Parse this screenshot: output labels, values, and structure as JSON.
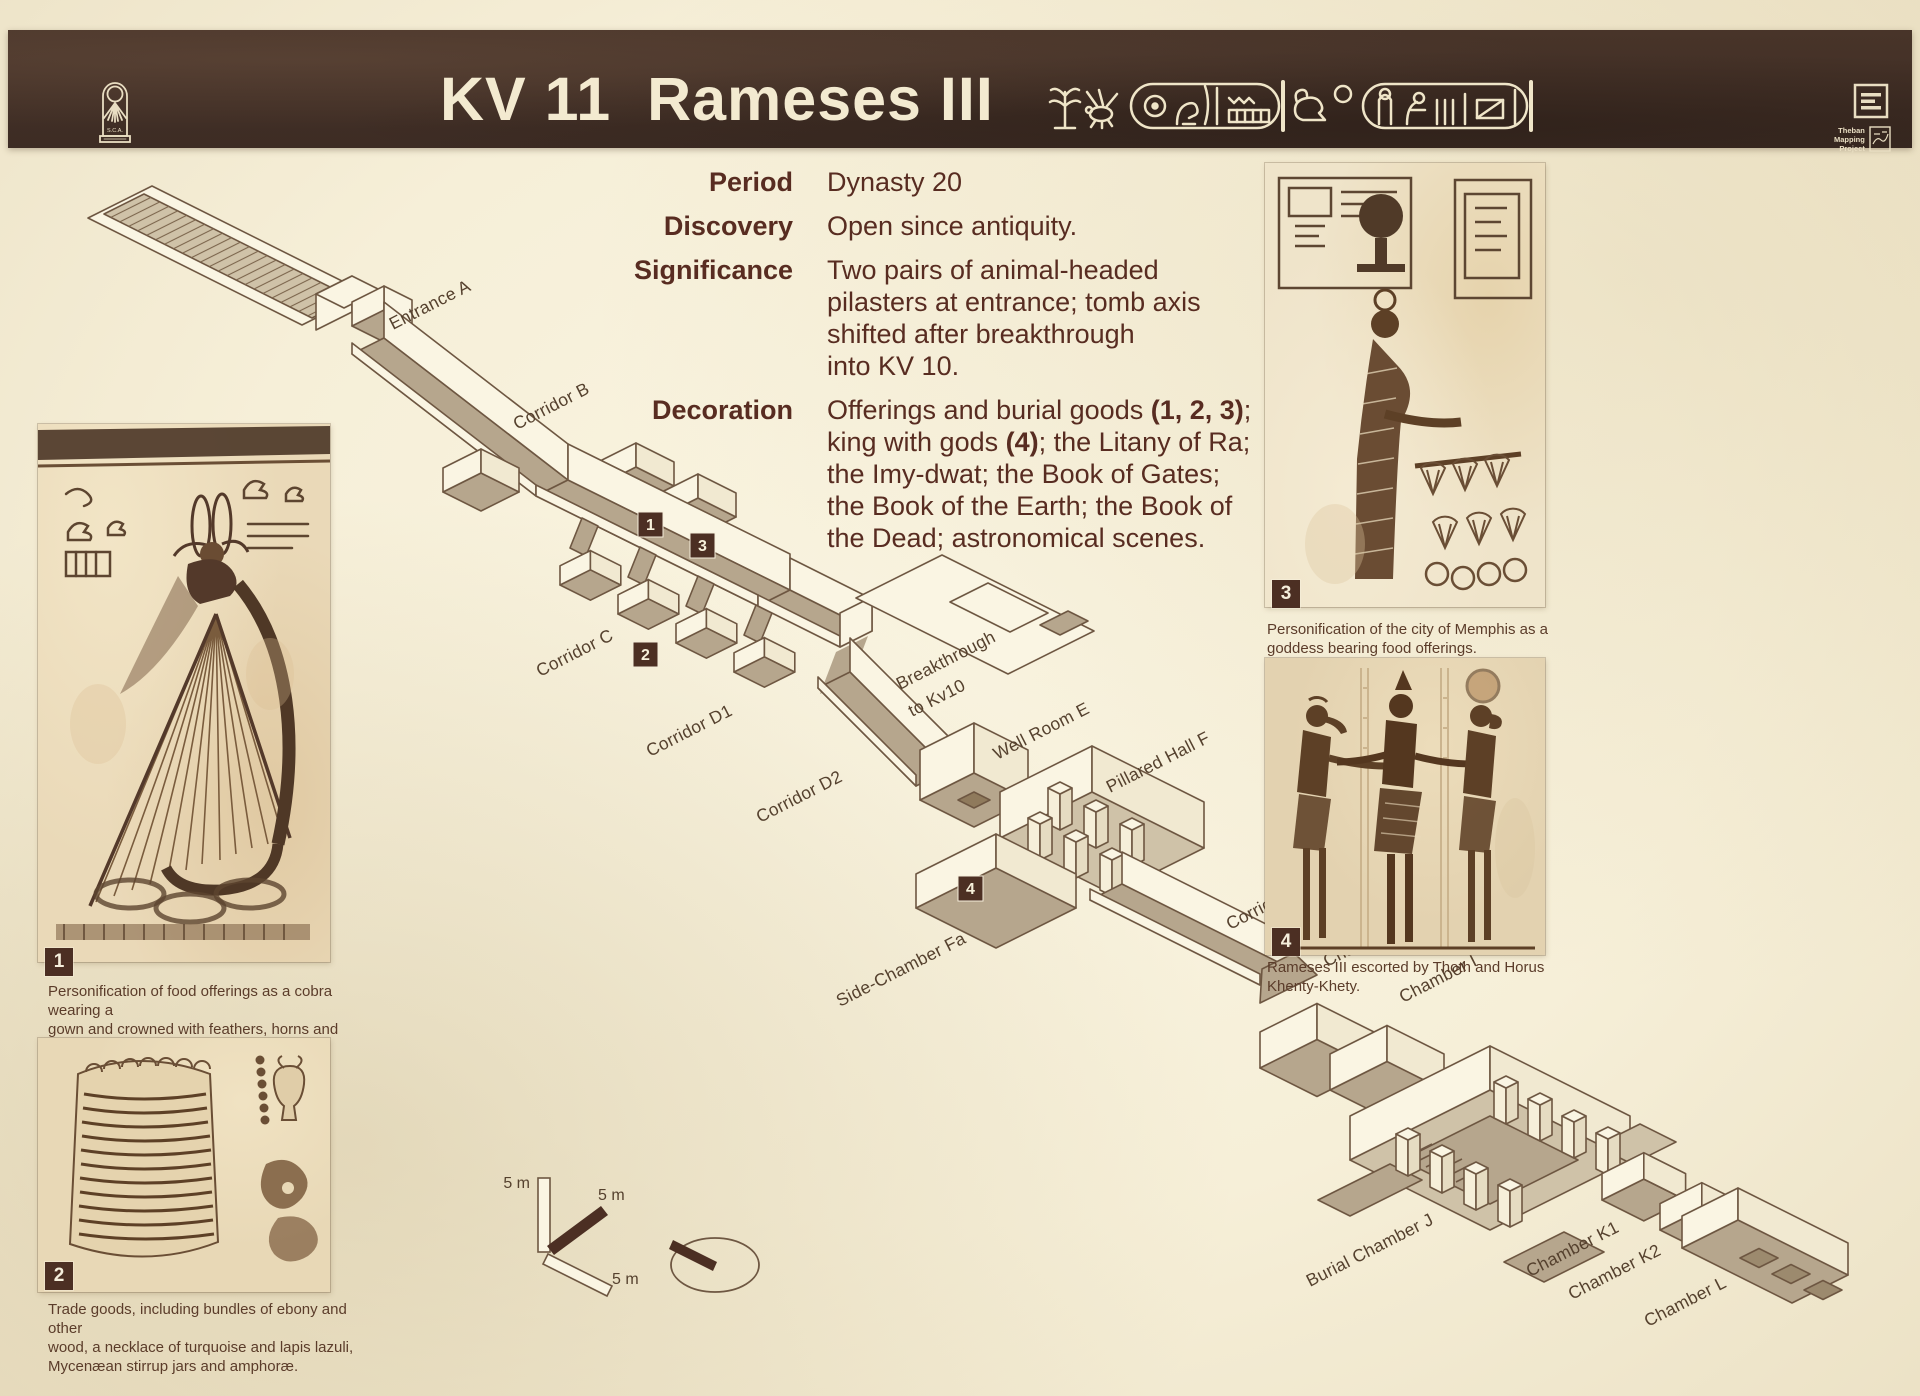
{
  "colors": {
    "header_bg": "#3f2e26",
    "cream": "#f6efd8",
    "accent_text": "#582c21",
    "diagram_tan": "#b6a68d",
    "diagram_line": "#6e5742",
    "marker_bg": "#4c2f23"
  },
  "header": {
    "title": "KV 11  Rameses III",
    "hieroglyphs_icon": "pharaoh-cartouche-hieroglyphs-icon",
    "sca_logo": {
      "icon": "sca-cartouche-sun-logo-icon",
      "text": "S.C.A."
    },
    "publisher_logo_icon": "press-lines-logo-icon",
    "tmp_logo": {
      "icon": "theban-mapping-project-logo-icon",
      "text": "Theban\nMapping\nProject"
    }
  },
  "info": {
    "rows": [
      {
        "label": "Period",
        "value": "Dynasty 20"
      },
      {
        "label": "Discovery",
        "value": "Open since antiquity."
      },
      {
        "label": "Significance",
        "value": "Two pairs of animal-headed\npilasters at entrance; tomb axis\nshifted after breakthrough\ninto KV 10."
      }
    ],
    "decoration_label": "Decoration",
    "decoration_segments": [
      {
        "text": "Offerings and burial goods ",
        "bold": false
      },
      {
        "text": "(1, 2, 3)",
        "bold": true
      },
      {
        "text": ";\nking with gods ",
        "bold": false
      },
      {
        "text": "(4)",
        "bold": true
      },
      {
        "text": "; the Litany of Ra;\nthe Imy-dwat; the Book of Gates;\nthe Book of the Earth; the Book of\nthe Dead; astronomical scenes.",
        "bold": false
      }
    ]
  },
  "diagram": {
    "labels": {
      "entrance_a": "Entrance A",
      "corridor_b": "Corridor B",
      "corridor_c": "Corridor C",
      "corridor_d1": "Corridor D1",
      "corridor_d2": "Corridor D2",
      "breakthrough_1": "Breakthrough",
      "breakthrough_2": "to Kv10",
      "well_room_e": "Well Room E",
      "pillared_hall_f": "Pillared Hall F",
      "side_chamber_fa": "Side-Chamber Fa",
      "corridor_g": "Corridor G",
      "chamber_h": "Chamber H",
      "chamber_i": "Chamber I",
      "burial_chamber_j": "Burial Chamber J",
      "chamber_k1": "Chamber K1",
      "chamber_k2": "Chamber K2",
      "chamber_l": "Chamber L"
    },
    "markers": {
      "m1": "1",
      "m2": "2",
      "m3": "3",
      "m4": "4"
    },
    "scale": {
      "s1": "5 m",
      "s2": "5 m",
      "s3": "5 m"
    },
    "compass_icon": "orientation-compass-ellipse-icon"
  },
  "figures": [
    {
      "number": "1",
      "art_icon": "cobra-goddess-painting-icon",
      "caption": "Personification of food offerings as a cobra wearing a\ngown and crowned with feathers, horns and sun disk."
    },
    {
      "number": "2",
      "art_icon": "trade-goods-painting-icon",
      "caption": "Trade goods, including bundles of ebony and other\nwood, a necklace of turquoise and lapis lazuli,\nMycenæan stirrup jars and amphoræ."
    },
    {
      "number": "3",
      "art_icon": "memphis-goddess-painting-icon",
      "caption": "Personification of the city of Memphis as a\ngoddess bearing food offerings."
    },
    {
      "number": "4",
      "art_icon": "rameses-thoth-horus-painting-icon",
      "caption": "Rameses III escorted by Thoth and Horus Khenty-Khety."
    }
  ]
}
